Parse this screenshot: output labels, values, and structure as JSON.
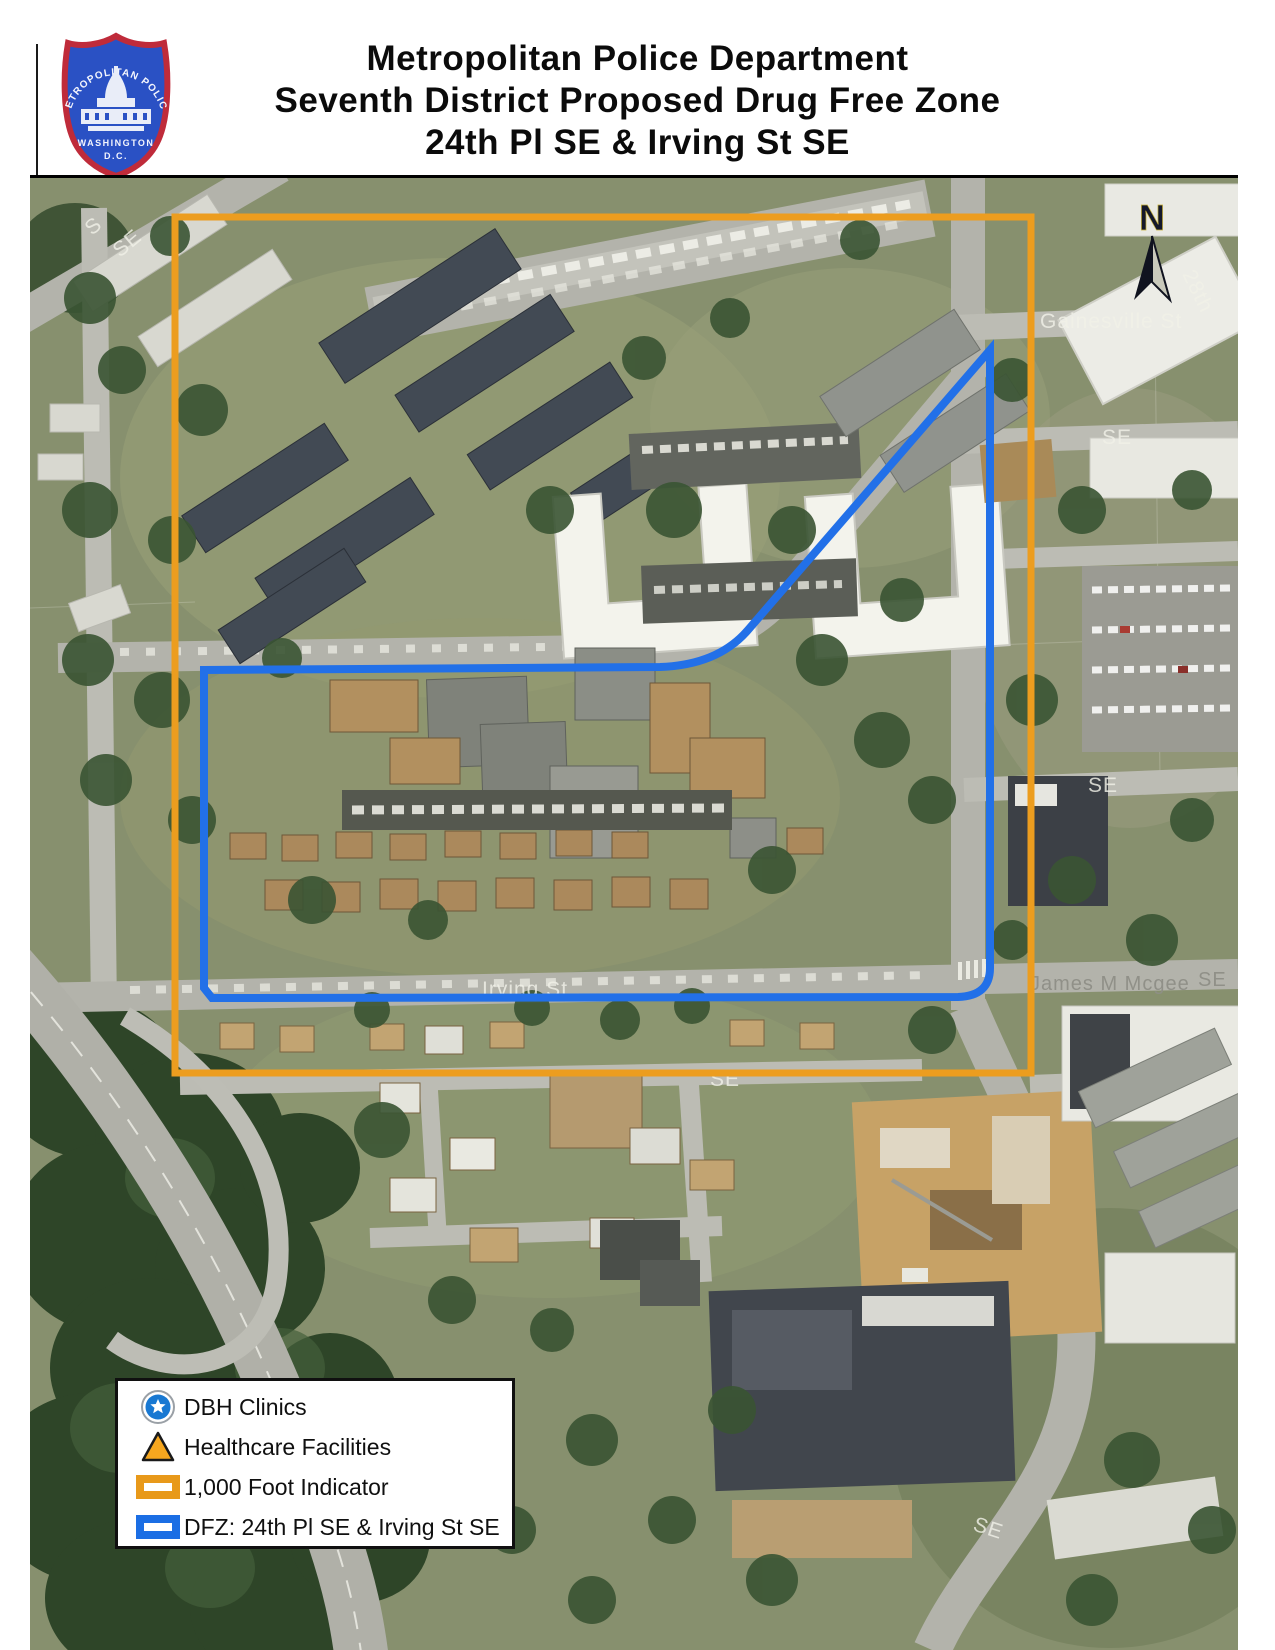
{
  "header": {
    "title_lines": [
      "Metropolitan Police Department",
      "Seventh District Proposed Drug Free Zone",
      "24th Pl SE & Irving St SE"
    ],
    "badge": {
      "arc_text": "METROPOLITAN POLICE",
      "city_text": "WASHINGTON",
      "dc_text": "D.C."
    }
  },
  "map": {
    "north_label": "N",
    "street_labels": [
      {
        "id": "gainesville-st",
        "text": "Gainesville St"
      },
      {
        "id": "28th-st",
        "text": "28th"
      },
      {
        "id": "se-upper-right",
        "text": "SE"
      },
      {
        "id": "se-mid-right",
        "text": "SE"
      },
      {
        "id": "irving-st",
        "text": "Irving St"
      },
      {
        "id": "james-m-mcgee",
        "text": "James M Mcgee"
      },
      {
        "id": "mcgee-se",
        "text": "SE"
      },
      {
        "id": "se-below-zone",
        "text": "SE"
      },
      {
        "id": "se-bottom-right",
        "text": "SE"
      },
      {
        "id": "se-top-left",
        "text": "SE"
      },
      {
        "id": "s-top-left",
        "text": "S"
      }
    ],
    "overlay_colors": {
      "foot_indicator": "#EC9D1F",
      "dfz": "#2270E8"
    }
  },
  "legend": {
    "items": [
      {
        "label": "DBH Clinics",
        "icon": "dbh-clinic-marker"
      },
      {
        "label": "Healthcare Facilities",
        "icon": "healthcare-facility-triangle"
      },
      {
        "label": "1,000 Foot Indicator",
        "icon": "foot-indicator-swatch"
      },
      {
        "label": "DFZ: 24th Pl SE & Irving St SE",
        "icon": "dfz-swatch"
      }
    ]
  }
}
